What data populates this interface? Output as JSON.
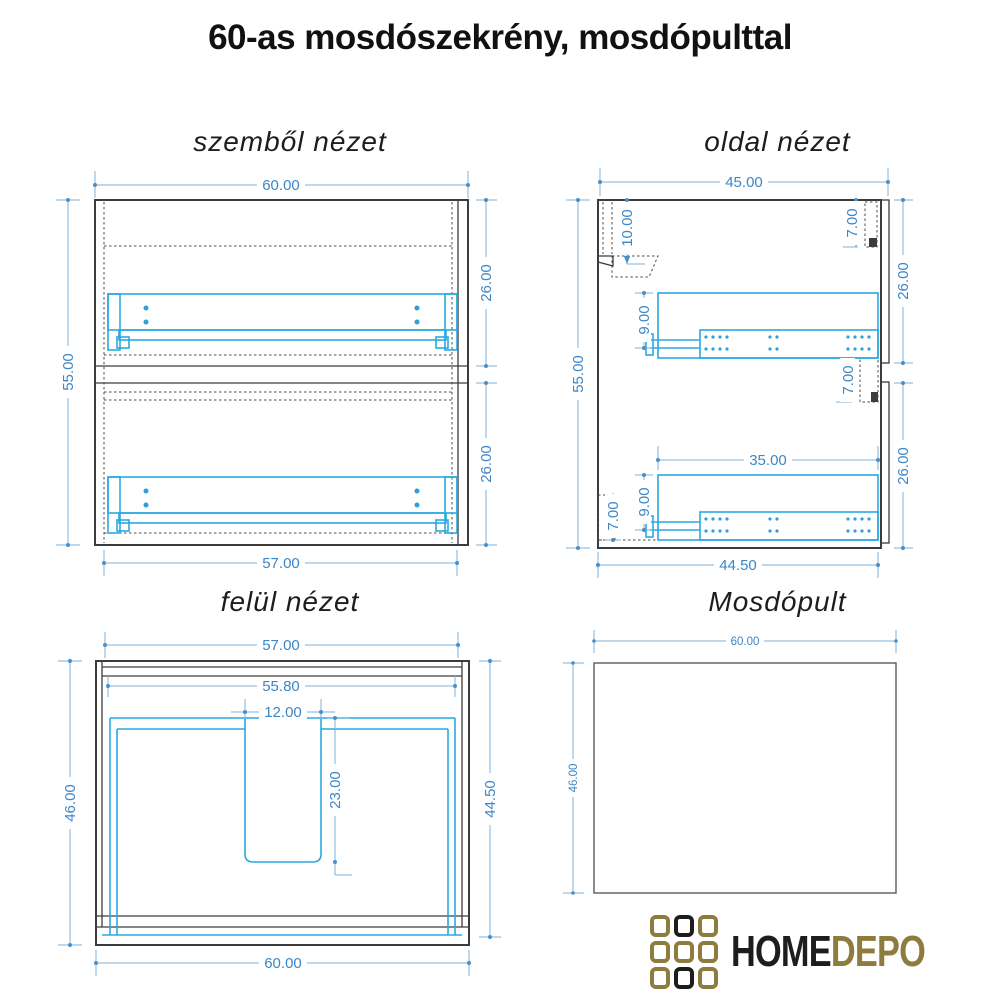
{
  "page_title": "60-as mosdószekrény, mosdópulttal",
  "views": {
    "front": {
      "title": "szemből nézet",
      "dim_top": "60.00",
      "dim_left": "55.00",
      "dim_right_upper": "26.00",
      "dim_right_lower": "26.00",
      "dim_bottom": "57.00"
    },
    "side": {
      "title": "oldal nézet",
      "dim_top": "45.00",
      "dim_left": "55.00",
      "dim_right_upper": "26.00",
      "dim_right_lower": "26.00",
      "dim_bottom": "44.50",
      "dim_back_rail": "10.00",
      "dim_front_rail_top": "7.00",
      "dim_front_rail_mid": "7.00",
      "dim_back_foot": "7.00",
      "dim_slide_upper": "9.00",
      "dim_slide_lower": "9.00",
      "dim_slide_length": "35.00"
    },
    "top": {
      "title": "felül nézet",
      "dim_top": "57.00",
      "dim_inner_width": "55.80",
      "dim_cutout_width": "12.00",
      "dim_cutout_depth": "23.00",
      "dim_left": "46.00",
      "dim_right": "44.50",
      "dim_bottom": "60.00"
    },
    "counter": {
      "title": "Mosdópult",
      "dim_top": "60.00",
      "dim_left": "46.00"
    }
  },
  "logo": {
    "brand_black": "HOME",
    "brand_gold": "DEPO"
  },
  "colors": {
    "dimension_blue": "#3c86c7",
    "dimension_line": "#7fb2d9",
    "drawer_blue": "#29a9e1",
    "line_dark": "#3c3c3c",
    "logo_gold": "#8d7c3e",
    "logo_black": "#1d1d1b"
  }
}
